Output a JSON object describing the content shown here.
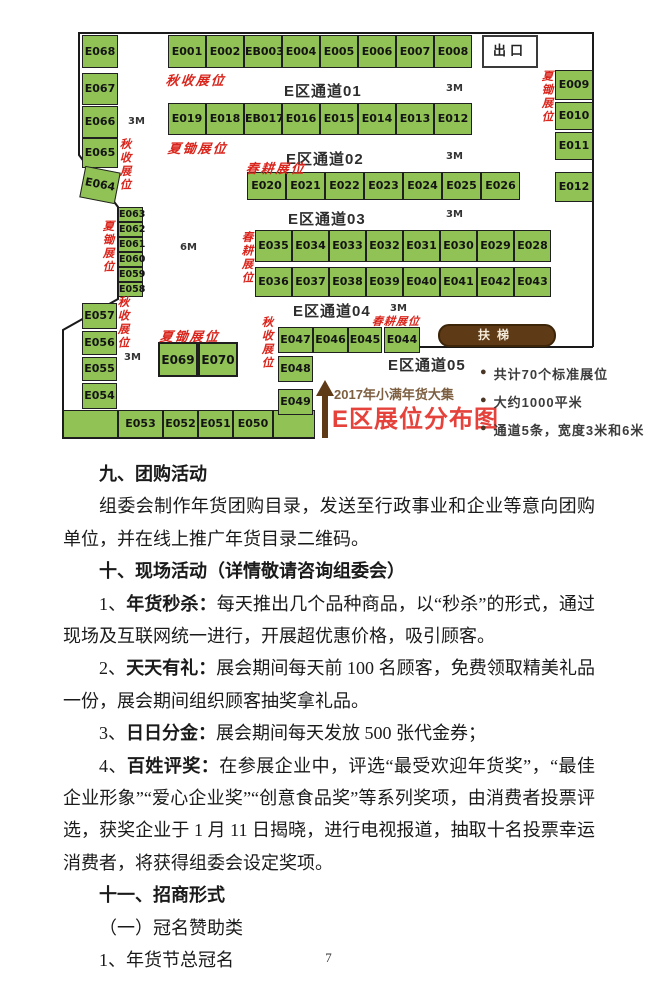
{
  "map": {
    "title_line1": "2017年小满年货大集",
    "title_line2": "E区展位分布图",
    "exit_label": "出口",
    "escalator_label": "扶梯",
    "exit_box": {
      "x": 422,
      "y": 7,
      "w": 56,
      "h": 33
    },
    "escalator_box": {
      "x": 378,
      "y": 296,
      "w": 118,
      "h": 23
    },
    "booths": [
      {
        "l": "E001",
        "x": 108,
        "y": 7,
        "w": 38,
        "h": 33
      },
      {
        "l": "E002",
        "x": 146,
        "y": 7,
        "w": 38,
        "h": 33
      },
      {
        "l": "EB003",
        "x": 184,
        "y": 7,
        "w": 38,
        "h": 33
      },
      {
        "l": "E004",
        "x": 222,
        "y": 7,
        "w": 38,
        "h": 33
      },
      {
        "l": "E005",
        "x": 260,
        "y": 7,
        "w": 38,
        "h": 33
      },
      {
        "l": "E006",
        "x": 298,
        "y": 7,
        "w": 38,
        "h": 33
      },
      {
        "l": "E007",
        "x": 336,
        "y": 7,
        "w": 38,
        "h": 33
      },
      {
        "l": "E008",
        "x": 374,
        "y": 7,
        "w": 38,
        "h": 33
      },
      {
        "l": "E019",
        "x": 108,
        "y": 75,
        "w": 38,
        "h": 32
      },
      {
        "l": "E018",
        "x": 146,
        "y": 75,
        "w": 38,
        "h": 32
      },
      {
        "l": "EB017",
        "x": 184,
        "y": 75,
        "w": 38,
        "h": 32
      },
      {
        "l": "E016",
        "x": 222,
        "y": 75,
        "w": 38,
        "h": 32
      },
      {
        "l": "E015",
        "x": 260,
        "y": 75,
        "w": 38,
        "h": 32
      },
      {
        "l": "E014",
        "x": 298,
        "y": 75,
        "w": 38,
        "h": 32
      },
      {
        "l": "E013",
        "x": 336,
        "y": 75,
        "w": 38,
        "h": 32
      },
      {
        "l": "E012",
        "x": 374,
        "y": 75,
        "w": 38,
        "h": 32
      },
      {
        "l": "E020",
        "x": 187,
        "y": 144,
        "w": 39,
        "h": 28
      },
      {
        "l": "E021",
        "x": 226,
        "y": 144,
        "w": 39,
        "h": 28
      },
      {
        "l": "E022",
        "x": 265,
        "y": 144,
        "w": 39,
        "h": 28
      },
      {
        "l": "E023",
        "x": 304,
        "y": 144,
        "w": 39,
        "h": 28
      },
      {
        "l": "E024",
        "x": 343,
        "y": 144,
        "w": 39,
        "h": 28
      },
      {
        "l": "E025",
        "x": 382,
        "y": 144,
        "w": 39,
        "h": 28
      },
      {
        "l": "E026",
        "x": 421,
        "y": 144,
        "w": 39,
        "h": 28
      },
      {
        "l": "E035",
        "x": 195,
        "y": 202,
        "w": 37,
        "h": 32
      },
      {
        "l": "E034",
        "x": 232,
        "y": 202,
        "w": 37,
        "h": 32
      },
      {
        "l": "E033",
        "x": 269,
        "y": 202,
        "w": 37,
        "h": 32
      },
      {
        "l": "E032",
        "x": 306,
        "y": 202,
        "w": 37,
        "h": 32
      },
      {
        "l": "E031",
        "x": 343,
        "y": 202,
        "w": 37,
        "h": 32
      },
      {
        "l": "E030",
        "x": 380,
        "y": 202,
        "w": 37,
        "h": 32
      },
      {
        "l": "E029",
        "x": 417,
        "y": 202,
        "w": 37,
        "h": 32
      },
      {
        "l": "E028",
        "x": 454,
        "y": 202,
        "w": 37,
        "h": 32
      },
      {
        "l": "E036",
        "x": 195,
        "y": 239,
        "w": 37,
        "h": 30
      },
      {
        "l": "E037",
        "x": 232,
        "y": 239,
        "w": 37,
        "h": 30
      },
      {
        "l": "E038",
        "x": 269,
        "y": 239,
        "w": 37,
        "h": 30
      },
      {
        "l": "E039",
        "x": 306,
        "y": 239,
        "w": 37,
        "h": 30
      },
      {
        "l": "E040",
        "x": 343,
        "y": 239,
        "w": 37,
        "h": 30
      },
      {
        "l": "E041",
        "x": 380,
        "y": 239,
        "w": 37,
        "h": 30
      },
      {
        "l": "E042",
        "x": 417,
        "y": 239,
        "w": 37,
        "h": 30
      },
      {
        "l": "E043",
        "x": 454,
        "y": 239,
        "w": 37,
        "h": 30
      },
      {
        "l": "E068",
        "x": 22,
        "y": 7,
        "w": 36,
        "h": 33
      },
      {
        "l": "E067",
        "x": 22,
        "y": 45,
        "w": 36,
        "h": 32
      },
      {
        "l": "E066",
        "x": 22,
        "y": 78,
        "w": 36,
        "h": 32
      },
      {
        "l": "E065",
        "x": 22,
        "y": 110,
        "w": 36,
        "h": 30
      },
      {
        "l": "E064",
        "x": 22,
        "y": 141,
        "w": 36,
        "h": 32,
        "cls": "tilt"
      },
      {
        "l": "E063",
        "x": 58,
        "y": 179,
        "w": 25,
        "h": 15,
        "cls": "small"
      },
      {
        "l": "E062",
        "x": 58,
        "y": 194,
        "w": 25,
        "h": 15,
        "cls": "small"
      },
      {
        "l": "E061",
        "x": 58,
        "y": 209,
        "w": 25,
        "h": 15,
        "cls": "small"
      },
      {
        "l": "E060",
        "x": 58,
        "y": 224,
        "w": 25,
        "h": 15,
        "cls": "small"
      },
      {
        "l": "E059",
        "x": 58,
        "y": 239,
        "w": 25,
        "h": 15,
        "cls": "small"
      },
      {
        "l": "E058",
        "x": 58,
        "y": 254,
        "w": 25,
        "h": 15,
        "cls": "small"
      },
      {
        "l": "E057",
        "x": 22,
        "y": 275,
        "w": 35,
        "h": 26
      },
      {
        "l": "E056",
        "x": 22,
        "y": 303,
        "w": 35,
        "h": 24
      },
      {
        "l": "E055",
        "x": 22,
        "y": 329,
        "w": 35,
        "h": 24
      },
      {
        "l": "E054",
        "x": 22,
        "y": 355,
        "w": 35,
        "h": 26
      },
      {
        "l": "",
        "x": 3,
        "y": 382,
        "w": 55,
        "h": 28
      },
      {
        "l": "E053",
        "x": 58,
        "y": 382,
        "w": 45,
        "h": 28
      },
      {
        "l": "E052",
        "x": 103,
        "y": 382,
        "w": 35,
        "h": 28
      },
      {
        "l": "E051",
        "x": 138,
        "y": 382,
        "w": 35,
        "h": 28
      },
      {
        "l": "E050",
        "x": 173,
        "y": 382,
        "w": 40,
        "h": 28
      },
      {
        "l": "",
        "x": 213,
        "y": 382,
        "w": 42,
        "h": 28
      },
      {
        "l": "E069",
        "x": 98,
        "y": 314,
        "w": 40,
        "h": 35,
        "cls": "thick"
      },
      {
        "l": "E070",
        "x": 138,
        "y": 314,
        "w": 40,
        "h": 35,
        "cls": "thick"
      },
      {
        "l": "E009",
        "x": 495,
        "y": 42,
        "w": 38,
        "h": 30
      },
      {
        "l": "E010",
        "x": 495,
        "y": 74,
        "w": 38,
        "h": 28
      },
      {
        "l": "E011",
        "x": 495,
        "y": 104,
        "w": 38,
        "h": 28
      },
      {
        "l": "E012",
        "x": 495,
        "y": 144,
        "w": 38,
        "h": 30
      },
      {
        "l": "E047",
        "x": 218,
        "y": 299,
        "w": 35,
        "h": 26
      },
      {
        "l": "E046",
        "x": 253,
        "y": 299,
        "w": 35,
        "h": 26
      },
      {
        "l": "E045",
        "x": 288,
        "y": 299,
        "w": 34,
        "h": 26
      },
      {
        "l": "E044",
        "x": 324,
        "y": 299,
        "w": 36,
        "h": 26
      },
      {
        "l": "E048",
        "x": 218,
        "y": 328,
        "w": 35,
        "h": 26
      },
      {
        "l": "E049",
        "x": 218,
        "y": 361,
        "w": 35,
        "h": 26
      }
    ],
    "aisles": [
      {
        "label": "E区通道01",
        "x": 224,
        "y": 52
      },
      {
        "label": "E区通道02",
        "x": 226,
        "y": 120
      },
      {
        "label": "E区通道03",
        "x": 228,
        "y": 180
      },
      {
        "label": "E区通道04",
        "x": 233,
        "y": 272
      },
      {
        "label": "E区通道05",
        "x": 328,
        "y": 326
      }
    ],
    "dims": [
      {
        "label": "3M",
        "x": 386,
        "y": 55
      },
      {
        "label": "3M",
        "x": 68,
        "y": 88
      },
      {
        "label": "3M",
        "x": 386,
        "y": 123
      },
      {
        "label": "3M",
        "x": 386,
        "y": 181
      },
      {
        "label": "3M",
        "x": 330,
        "y": 275
      },
      {
        "label": "3M",
        "x": 64,
        "y": 324
      },
      {
        "label": "6M",
        "x": 120,
        "y": 214
      }
    ],
    "red_labels": [
      {
        "text": "秋收展位",
        "x": 106,
        "y": 42,
        "v": false
      },
      {
        "text": "夏锄展位",
        "x": 108,
        "y": 110,
        "v": false
      },
      {
        "text": "春耕展位",
        "x": 186,
        "y": 130,
        "v": false
      },
      {
        "text": "春耕展位",
        "x": 181,
        "y": 203,
        "v": true
      },
      {
        "text": "春耕展位",
        "x": 312,
        "y": 285,
        "v": false,
        "small": true
      },
      {
        "text": "夏锄展位",
        "x": 100,
        "y": 298,
        "v": false
      },
      {
        "text": "秋收展位",
        "x": 59,
        "y": 110,
        "v": true
      },
      {
        "text": "夏锄展位",
        "x": 42,
        "y": 192,
        "v": true
      },
      {
        "text": "秋收展位",
        "x": 57,
        "y": 268,
        "v": true
      },
      {
        "text": "秋收展位",
        "x": 201,
        "y": 288,
        "v": true
      },
      {
        "text": "夏锄展位",
        "x": 481,
        "y": 42,
        "v": true
      }
    ],
    "bullets": [
      "共计70个标准展位",
      "大约1000平米",
      "通道5条，宽度3米和6米"
    ],
    "booth_color": "#90c255",
    "red_color": "#d9251c"
  },
  "document": {
    "sections": [
      {
        "type": "h",
        "text": "九、团购活动"
      },
      {
        "type": "p",
        "runs": [
          {
            "t": "组委会制作年货团购目录，发送至行政事业和企业等意向团购单位，并在线上推广年货目录二维码。"
          }
        ]
      },
      {
        "type": "h",
        "text": "十、现场活动（详情敬请咨询组委会）"
      },
      {
        "type": "p",
        "runs": [
          {
            "t": "1、"
          },
          {
            "t": "年货秒杀：",
            "b": true
          },
          {
            "t": "每天推出几个品种商品，以“秒杀”的形式，通过现场及互联网统一进行，开展超优惠价格，吸引顾客。"
          }
        ]
      },
      {
        "type": "p",
        "runs": [
          {
            "t": "2、"
          },
          {
            "t": "天天有礼：",
            "b": true
          },
          {
            "t": "展会期间每天前 100 名顾客，免费领取精美礼品一份，展会期间组织顾客抽奖拿礼品。"
          }
        ]
      },
      {
        "type": "p",
        "runs": [
          {
            "t": "3、"
          },
          {
            "t": "日日分金：",
            "b": true
          },
          {
            "t": "展会期间每天发放 500 张代金券；"
          }
        ]
      },
      {
        "type": "p",
        "runs": [
          {
            "t": "4、"
          },
          {
            "t": "百姓评奖：",
            "b": true
          },
          {
            "t": "在参展企业中，评选“最受欢迎年货奖”，“最佳企业形象”“爱心企业奖”“创意食品奖”等系列奖项，由消费者投票评选，获奖企业于 1 月 11 日揭晓，进行电视报道，抽取十名投票幸运消费者，将获得组委会设定奖项。"
          }
        ]
      },
      {
        "type": "h",
        "text": "十一、招商形式"
      },
      {
        "type": "p",
        "runs": [
          {
            "t": "（一）冠名赞助类"
          }
        ]
      },
      {
        "type": "p",
        "runs": [
          {
            "t": "1、年货节总冠名"
          }
        ]
      }
    ],
    "page_number": "7"
  }
}
